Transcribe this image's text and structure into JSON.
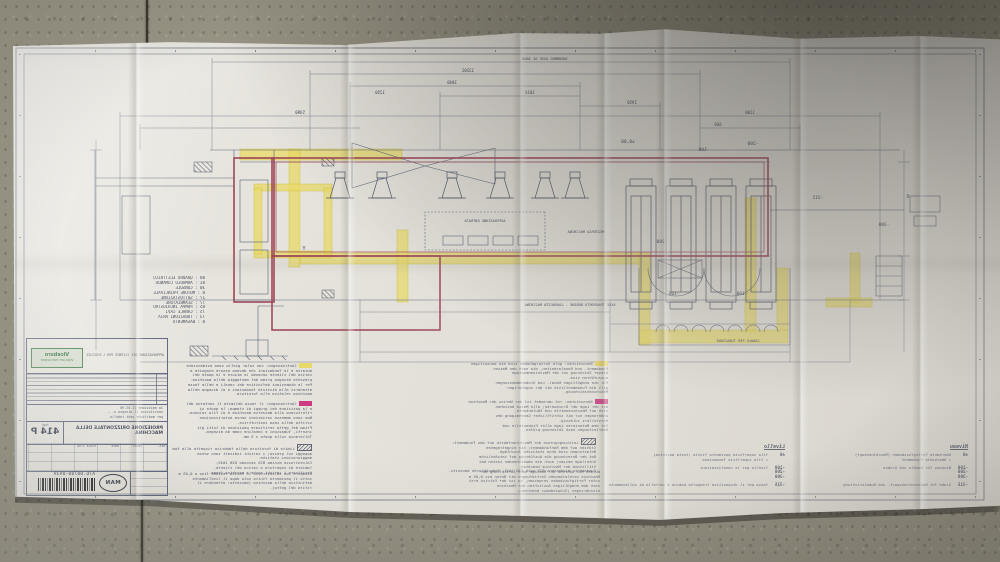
{
  "colors": {
    "accent_red": "#9c4455",
    "highlight_yellow": "#e9d95f",
    "highlight_magenta": "#cc2d7c",
    "ink": "#4d5368",
    "paper": "#e6e4dd",
    "floor": "#8e8a7c",
    "stamp_green": "#3f7d46"
  },
  "title_block": {
    "approval_line": "APPROVAZIONE DEL CLIENTE PER L'ESECUZIONE",
    "stamp": {
      "line1": "Vicebsro",
      "line2": "visto per esecuzione"
    },
    "revision_note_lines": [
      "1a emissione 21.03.96",
      "sostituisce il disegno n. —",
      "per modifiche vedi tabella"
    ],
    "sheet_label": "fogl.",
    "sheet_number": "414 P",
    "title": "PROIEZIONE ORIZZONTALE DELLA MACCHINA",
    "grid_labels": [
      "dis.",
      "contr.",
      "data",
      "scala 1:50"
    ],
    "drawing_number": "A76.00700-0939",
    "logo": "MAN"
  },
  "legend": {
    "items": [
      {
        "no": "80",
        "label": "QUADRO ELETTRICO"
      },
      {
        "no": "81",
        "label": "ARMADIO COMANDO"
      },
      {
        "no": "30",
        "label": "CONSOLE"
      },
      {
        "no": "8",
        "label": "MOTORE PRINCIPALE"
      },
      {
        "no": "27",
        "label": "SOTTOSTAZIONE"
      },
      {
        "no": "77",
        "label": "SCAMBIATORE"
      },
      {
        "no": "85",
        "label": "POMPA INCHIOSTRO"
      },
      {
        "no": "75",
        "label": "CANALE CAVI"
      },
      {
        "no": "73",
        "label": "TUBAZIONI ARIA"
      },
      {
        "no": "8",
        "label": "BASAMENTO"
      }
    ]
  },
  "levels_it": {
    "heading": "Livello",
    "rows": [
      {
        "level": "±0",
        "text": "filo superficie pavimento finito (testa macchina)\n= filo superficie fondazione"
      },
      {
        "level": "-100\n-200\n-300",
        "text": "livello per le canalizzazioni"
      },
      {
        "level": "-315",
        "text": "fossa per il dispositivo trasporto bobine a carrello di sollevamento"
      }
    ]
  },
  "levels_de": {
    "heading": "Niveau",
    "rows": [
      {
        "level": "±0",
        "text": "Oberkante Fertigfussboden (Maschinenkopf)\n= Oberkante Fundament"
      },
      {
        "level": "-100\n-200\n-300",
        "text": "Niveaus für Kanäle und Gruben"
      },
      {
        "level": "-315",
        "text": "Grube für Bobinentransport- und Hubeinrichtung"
      }
    ]
  },
  "notes": [
    {
      "id": "it-yellow",
      "chip": "yellow",
      "x": 688,
      "y": 363,
      "w": 127,
      "lines": [
        "Contrassegno: con color giallo sono evidenziate le opere",
        "murarie e le fondazioni che devono essere eseguite a",
        "carico del cliente secondo le misure e le quote del",
        "presente disegno prima del montaggio della macchina.",
        "Per le dimensioni definitive dei canali e delle fosse",
        "attenersi alla distinta fondazioni e al disegno della",
        "macchina relativo alla fornitura."
      ]
    },
    {
      "id": "it-magenta",
      "chip": "magenta",
      "x": 688,
      "y": 401,
      "w": 125,
      "lines": [
        "Contrassegno: il rosso delimita il contorno della macchina",
        "e la posizione dei gruppi di stampa; le quote si",
        "riferiscono alla mezzeria macchina e al filo colonna.",
        "Non sono ammesse variazioni senza autorizzazione",
        "scritta della casa costruttrice.",
        "Prima del getto verificare posizione di tutti gli",
        "inserti, tubazioni e canaline come da disegno.",
        "Tolleranza sulle quote ± 5 mm."
      ]
    },
    {
      "id": "it-hatch",
      "chip": "hatch",
      "x": 688,
      "y": 444,
      "w": 140,
      "lines": [
        "Limite di fornitura della fabbrica rispetto alla fondazione:",
        "appoggi sul grezzo; i carichi indicati sono senza",
        "maggiorazioni statiche.",
        "Calcestruzzo minimo B25 secondo DIN 1045;",
        "lamiere di copertura a carico del cliente.",
        "Verificare i carichi anche a macchina ferma."
      ]
    },
    {
      "id": "it-plain",
      "chip": null,
      "x": 688,
      "y": 472,
      "w": 140,
      "lines": [
        "Riempire con calcestruzzo le cavità residue fino a 0,05 m",
        "sotto il pavimento finito solo dopo il livellamento",
        "definitivo della macchina (massetto: attendere il",
        "ritiro del getto)."
      ]
    },
    {
      "id": "de-yellow",
      "chip": "yellow",
      "x": 392,
      "y": 361,
      "w": 246,
      "lines": [
        "Kennzeichen: gelb hervorgehoben sind die bauseitigen",
        "Fundament- und Kanalarbeiten, die nach den Massen",
        "dieser Zeichnung vor der Maschinenmontage",
        "auszuführen sind.",
        "Für die endgültigen Kanal- und Grubenabmessungen",
        "gilt die Fundamentliste mit der zugehörigen",
        "Maschinenzeichnung."
      ]
    },
    {
      "id": "de-magenta",
      "chip": "magenta",
      "x": 392,
      "y": 399,
      "w": 246,
      "lines": [
        "Kennzeichen: rot umrandet ist der Umriss der Maschine",
        "mit der Lage der Druckwerke; alle Masse beziehen",
        "sich auf Maschinenmitte und Säulenkante.",
        "Änderungen nur mit schriftlicher Genehmigung des",
        "Herstellers zulässig.",
        "Vor dem Betonieren Lage aller Einbauteile und",
        "Rohrleitungen nach Zeichnung prüfen."
      ]
    },
    {
      "id": "de-hatch",
      "chip": "hatch",
      "x": 404,
      "y": 438,
      "w": 232,
      "lines": [
        "Leistungsgrenze der Maschinenfabrik auf das Fundament:",
        "Stützen auf dem Rohfundament; die eingetragenen",
        "Belastungen sind ohne statische Zuschläge.",
        "Bei der Berechnung die Ausführung auf tatsächliche",
        "Unterlage messen; auch die abweichenden Lasten bei",
        "Stillstand der Maschine beachten.",
        "Fundamente mindestens B25 nach DIN 1045; Abdeckbleche bauseits."
      ]
    },
    {
      "id": "de-plain",
      "chip": null,
      "x": 400,
      "y": 470,
      "w": 240,
      "lines": [
        "Wurden die während der Montage nach Aufstellung der",
        "Maschine verbleibenden Vertiefungen mit Beton bis 0,05 m",
        "unter Fertigfussboden vergossen, so ist der Estrich erst",
        "nach dem endgültigen Ausrichten der Maschine",
        "einzubringen (Schwindmass beachten)."
      ]
    }
  ],
  "drawing": {
    "labels": [
      {
        "t": "INGOMBRO ASSE DI 3000",
        "x": 455,
        "y": 59,
        "s": 3.6
      },
      {
        "t": "13201",
        "x": 532,
        "y": 71
      },
      {
        "t": "3840",
        "x": 548,
        "y": 83
      },
      {
        "t": "1014",
        "x": 470,
        "y": 93
      },
      {
        "t": "2950",
        "x": 368,
        "y": 103
      },
      {
        "t": "1100",
        "x": 250,
        "y": 113
      },
      {
        "t": "5490",
        "x": 700,
        "y": 113
      },
      {
        "t": "660",
        "x": 282,
        "y": 125
      },
      {
        "t": "1250",
        "x": 620,
        "y": 93
      },
      {
        "t": "±0,00",
        "x": 372,
        "y": 143,
        "s": 4.5
      },
      {
        "t": "-100",
        "x": 296,
        "y": 151,
        "s": 4.5
      },
      {
        "t": "-200",
        "x": 247,
        "y": 145,
        "s": 4.5
      },
      {
        "t": "-200",
        "x": 338,
        "y": 243,
        "s": 4.5
      },
      {
        "t": "-315",
        "x": 182,
        "y": 199,
        "s": 4.5
      },
      {
        "t": "-300",
        "x": 116,
        "y": 226,
        "s": 4.5
      },
      {
        "t": "-100",
        "x": 258,
        "y": 295,
        "s": 4.5
      },
      {
        "t": "-100",
        "x": 326,
        "y": 295,
        "s": 4.5
      },
      {
        "t": "X",
        "x": 92,
        "y": 197,
        "s": 5
      },
      {
        "t": "Y",
        "x": 696,
        "y": 249,
        "s": 5
      },
      {
        "t": "ASPIRAZIONE ENTRATA",
        "x": 515,
        "y": 221,
        "s": 3.6
      },
      {
        "t": "MEZZERIA MACCHINA",
        "x": 414,
        "y": 232,
        "s": 3.6
      },
      {
        "t": "CANALE PER TUBAZIONI",
        "x": 262,
        "y": 341,
        "s": 3.6
      },
      {
        "t": "ASSE TRASPORTO BOBINE - LARGHEZZA MACCHINA",
        "x": 430,
        "y": 305,
        "s": 3.6
      }
    ]
  }
}
